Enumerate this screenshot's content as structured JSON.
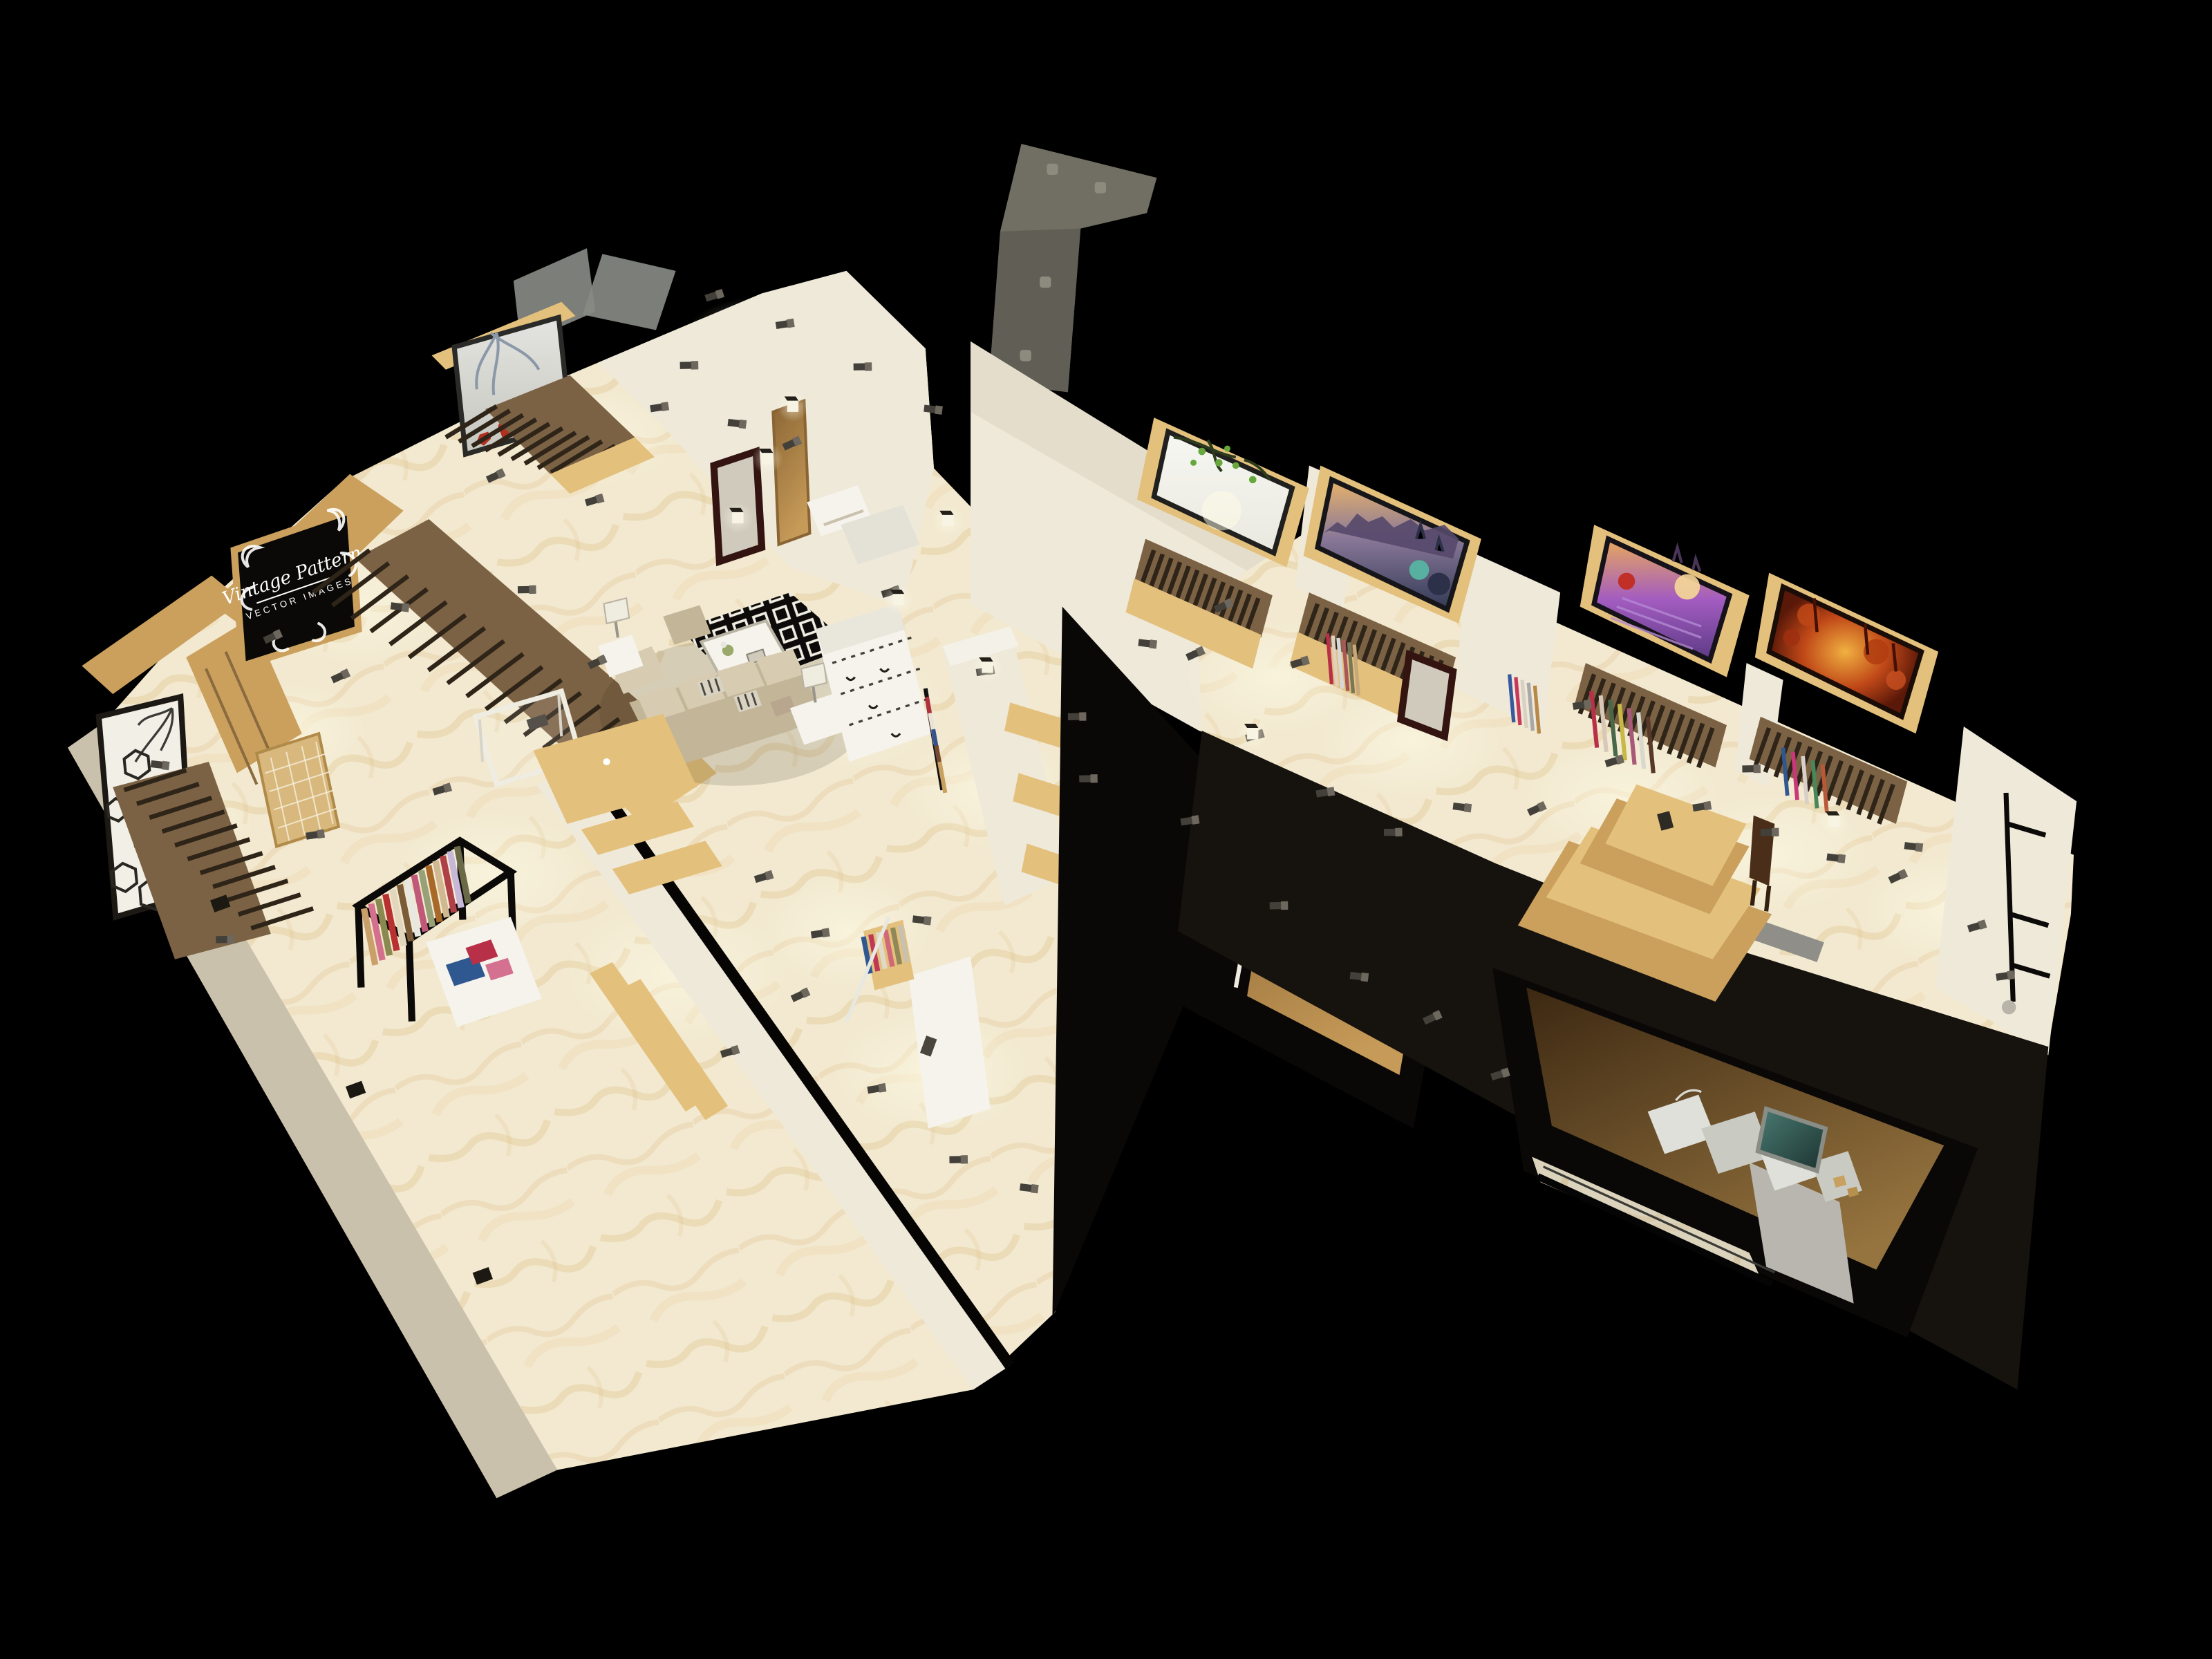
{
  "meta": {
    "description": "3D isometric cutaway render of a clothing boutique floor plan on black background",
    "view": "top-down oblique 3D render",
    "rooms": [
      "entry-vestibule",
      "reception",
      "lounge-display-hall",
      "jewelry-corner",
      "fitting-corridor",
      "gallery-hall",
      "back-stock-room"
    ]
  },
  "sign": {
    "line1": "Vintage Pattern",
    "line2": "VECTOR IMAGES"
  },
  "palette": {
    "bg": "#000000",
    "marble": "#f2e9d0",
    "marbleVein": "#ddb97c",
    "wallLight": "#efe9da",
    "wallMid": "#ddd5c2",
    "wallDim": "#c9c1ac",
    "wallDark": "#a99f8a",
    "woodLight": "#e3c07c",
    "woodMid": "#caa05c",
    "woodDark": "#8a6a3e",
    "slatBase": "#7c6244",
    "slatDark": "#2e2418",
    "inkBlack": "#0a0806",
    "charcoal": "#16130e",
    "white": "#f5f3ec",
    "offWhite": "#e4e1d6",
    "glassGray": "#878983",
    "soffitGray": "#716f63",
    "soffitDark": "#54524a",
    "mirrorFrame": "#331410",
    "doorWood": "#c69a58",
    "dimFloor": "#4a3118",
    "dimFloorLit": "#96743f",
    "sofaBase": "#c3b598",
    "sofaLight": "#d7cbb2",
    "benchGray": "#8f8e88",
    "spotGray": "#6d675d",
    "spotDark": "#43403a",
    "glow": "#fffbe6",
    "rugBlack": "#0d0b09",
    "signRed": "#c03028"
  },
  "artworks": [
    {
      "id": "red-deer-winter",
      "label": "red deer in winter branches",
      "colors": [
        "#e4e4e0",
        "#c6c6c0",
        "#b23020",
        "#8a98a8"
      ]
    },
    {
      "id": "spring-blossom",
      "label": "green blossom branch on white",
      "colors": [
        "#f7f7f2",
        "#e9e9e0",
        "#66a83c",
        "#2c3a1e"
      ]
    },
    {
      "id": "sunset-cityscape",
      "label": "old town skyline at sunset",
      "colors": [
        "#e8b36a",
        "#8a7898",
        "#323a56",
        "#57b0a0"
      ]
    },
    {
      "id": "lavender-field",
      "label": "lavender field at sunset",
      "colors": [
        "#e8a85c",
        "#a35cc0",
        "#5c3a86",
        "#f6d898"
      ]
    },
    {
      "id": "autumn-forest",
      "label": "glowing autumn forest path",
      "colors": [
        "#f0b040",
        "#c04818",
        "#5a1808",
        "#801e0a"
      ]
    },
    {
      "id": "teal-leaves",
      "label": "teal leaves picture in stock room",
      "colors": [
        "#4a7a72",
        "#1c3330"
      ]
    }
  ],
  "clothes": {
    "rack": [
      "#c9a06a",
      "#d4708e",
      "#8a8a50",
      "#b83030",
      "#e2d6bc",
      "#7a5c38",
      "#e8e8e0",
      "#c05878",
      "#98a078",
      "#a86828",
      "#d0b890",
      "#b04048",
      "#c8b8d8",
      "#6a6a48"
    ],
    "miniRack": [
      "#305890",
      "#c03858",
      "#e0d8c8",
      "#d06878",
      "#908858",
      "#c8c0b0"
    ],
    "corridorRack": [
      "#b03040",
      "#e8e4da",
      "#34538e",
      "#7a4a2e",
      "#c8a060"
    ],
    "folded": [
      "#305890",
      "#b83048",
      "#d47090"
    ],
    "scarves2": [
      "#b83048",
      "#e0d0c0",
      "#d8d8d8",
      "#a85858",
      "#787858",
      "#c8a878"
    ],
    "scarves3a": [
      "#3858a0",
      "#c83858",
      "#d8d0c0",
      "#a8a8a8",
      "#b88848"
    ],
    "scarves3b": [
      "#b83048",
      "#d8c8b8",
      "#486848",
      "#c8b848",
      "#a85878",
      "#d8d8d0",
      "#583828"
    ],
    "scarves4": [
      "#305890",
      "#c83878",
      "#d8d0c8",
      "#488858",
      "#b85838"
    ]
  },
  "lighting": {
    "track_spotlights": 55,
    "wall_sconces": 8,
    "ceiling_lights": 4
  }
}
